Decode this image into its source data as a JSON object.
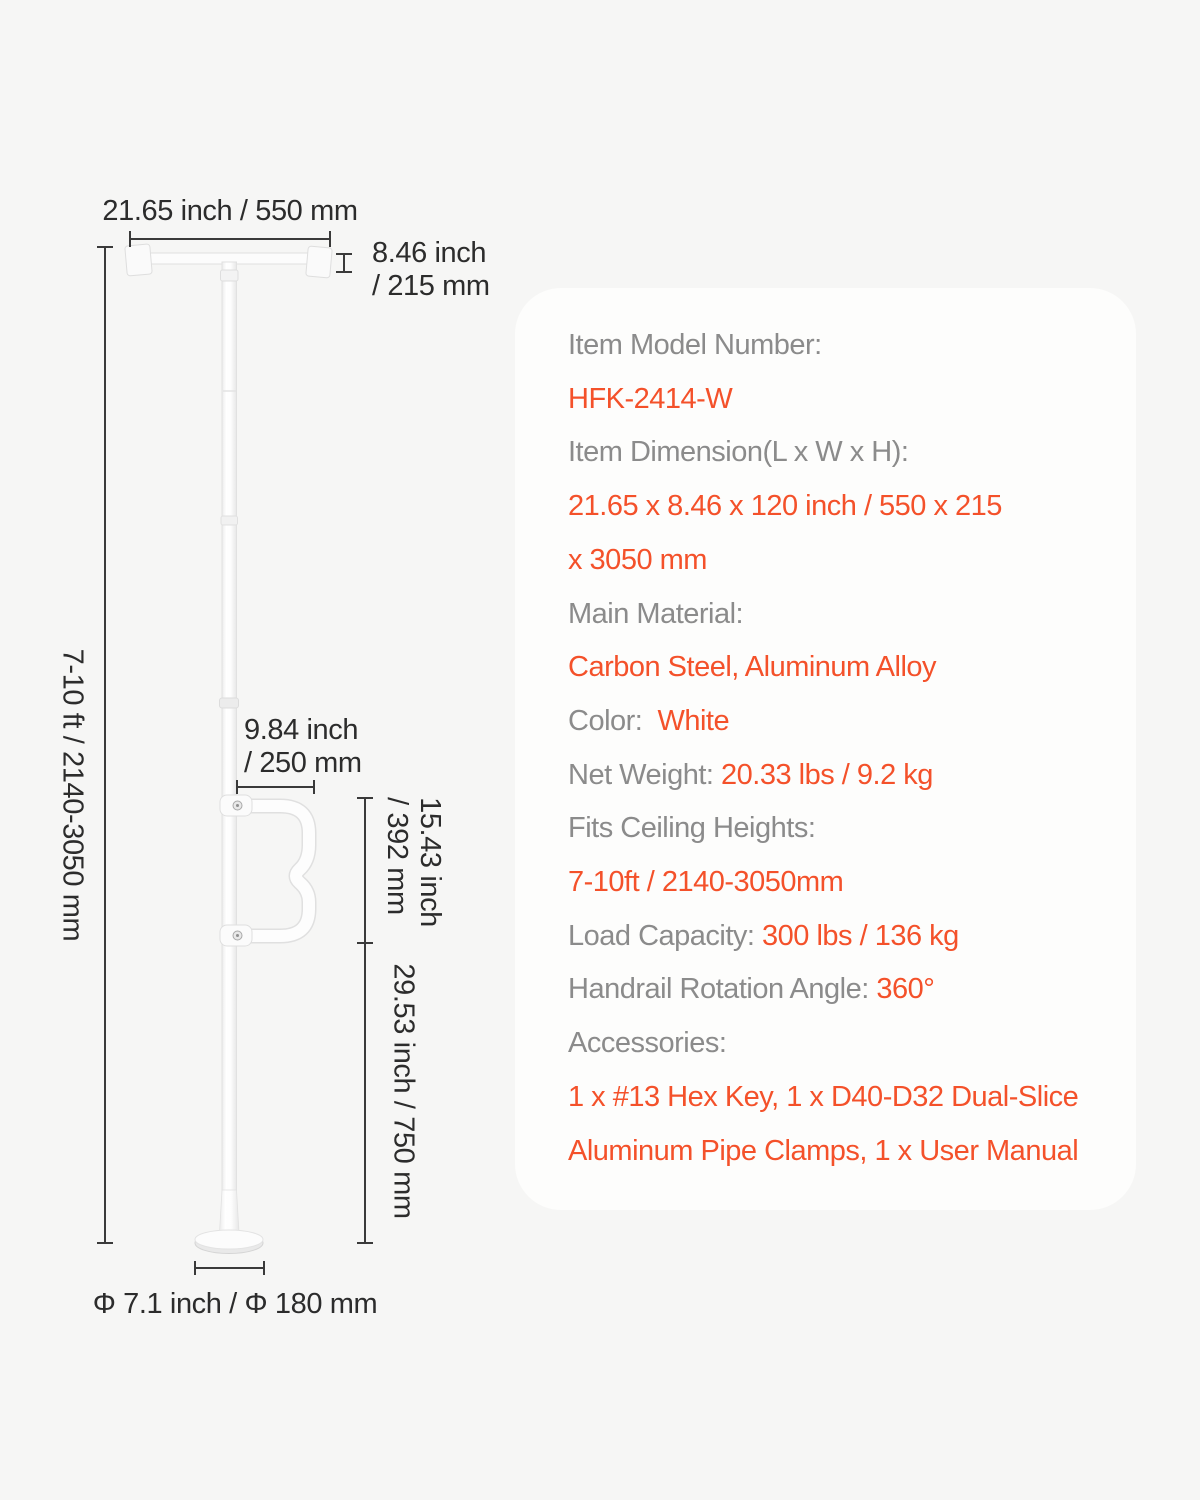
{
  "page": {
    "background": "#F6F6F5"
  },
  "diagram": {
    "text_color": "#2C2C2C",
    "line_color": "#3A3A3A",
    "dims": {
      "top_width": "21.65 inch / 550 mm",
      "ceiling_pad_line1": "8.46 inch",
      "ceiling_pad_line2": "/ 215 mm",
      "pole_height": "7-10 ft / 2140-3050 mm",
      "handrail_reach_line1": "9.84 inch",
      "handrail_reach_line2": "/ 250 mm",
      "handrail_span_line1": "15.43 inch",
      "handrail_span_line2": "/ 392 mm",
      "lower_section": "29.53 inch / 750 mm",
      "base_diameter": "Φ 7.1 inch / Φ 180 mm"
    }
  },
  "card": {
    "background": "#FDFDFC",
    "label_color": "#8B8B8B",
    "value_color": "#F4512A",
    "rows": [
      {
        "label": "Item Model Number:",
        "value": ""
      },
      {
        "label": "",
        "value": "HFK-2414-W"
      },
      {
        "label": "Item Dimension(L x W x H):",
        "value": ""
      },
      {
        "label": "",
        "value": "21.65 x 8.46 x 120 inch / 550 x 215"
      },
      {
        "label": "",
        "value": "x 3050 mm"
      },
      {
        "label": "Main Material:",
        "value": ""
      },
      {
        "label": "",
        "value": "Carbon Steel, Aluminum Alloy"
      },
      {
        "label": "Color:  ",
        "value": "White"
      },
      {
        "label": "Net Weight: ",
        "value": "20.33 lbs / 9.2 kg"
      },
      {
        "label": "Fits Ceiling Heights:",
        "value": ""
      },
      {
        "label": "",
        "value": "7-10ft / 2140-3050mm"
      },
      {
        "label": "Load Capacity: ",
        "value": "300 lbs / 136 kg"
      },
      {
        "label": "Handrail Rotation Angle: ",
        "value": "360°"
      },
      {
        "label": "Accessories:",
        "value": ""
      },
      {
        "label": "",
        "value": "1 x #13 Hex Key, 1 x D40-D32 Dual-Slice"
      },
      {
        "label": "",
        "value": "Aluminum Pipe Clamps, 1 x User Manual"
      }
    ]
  }
}
